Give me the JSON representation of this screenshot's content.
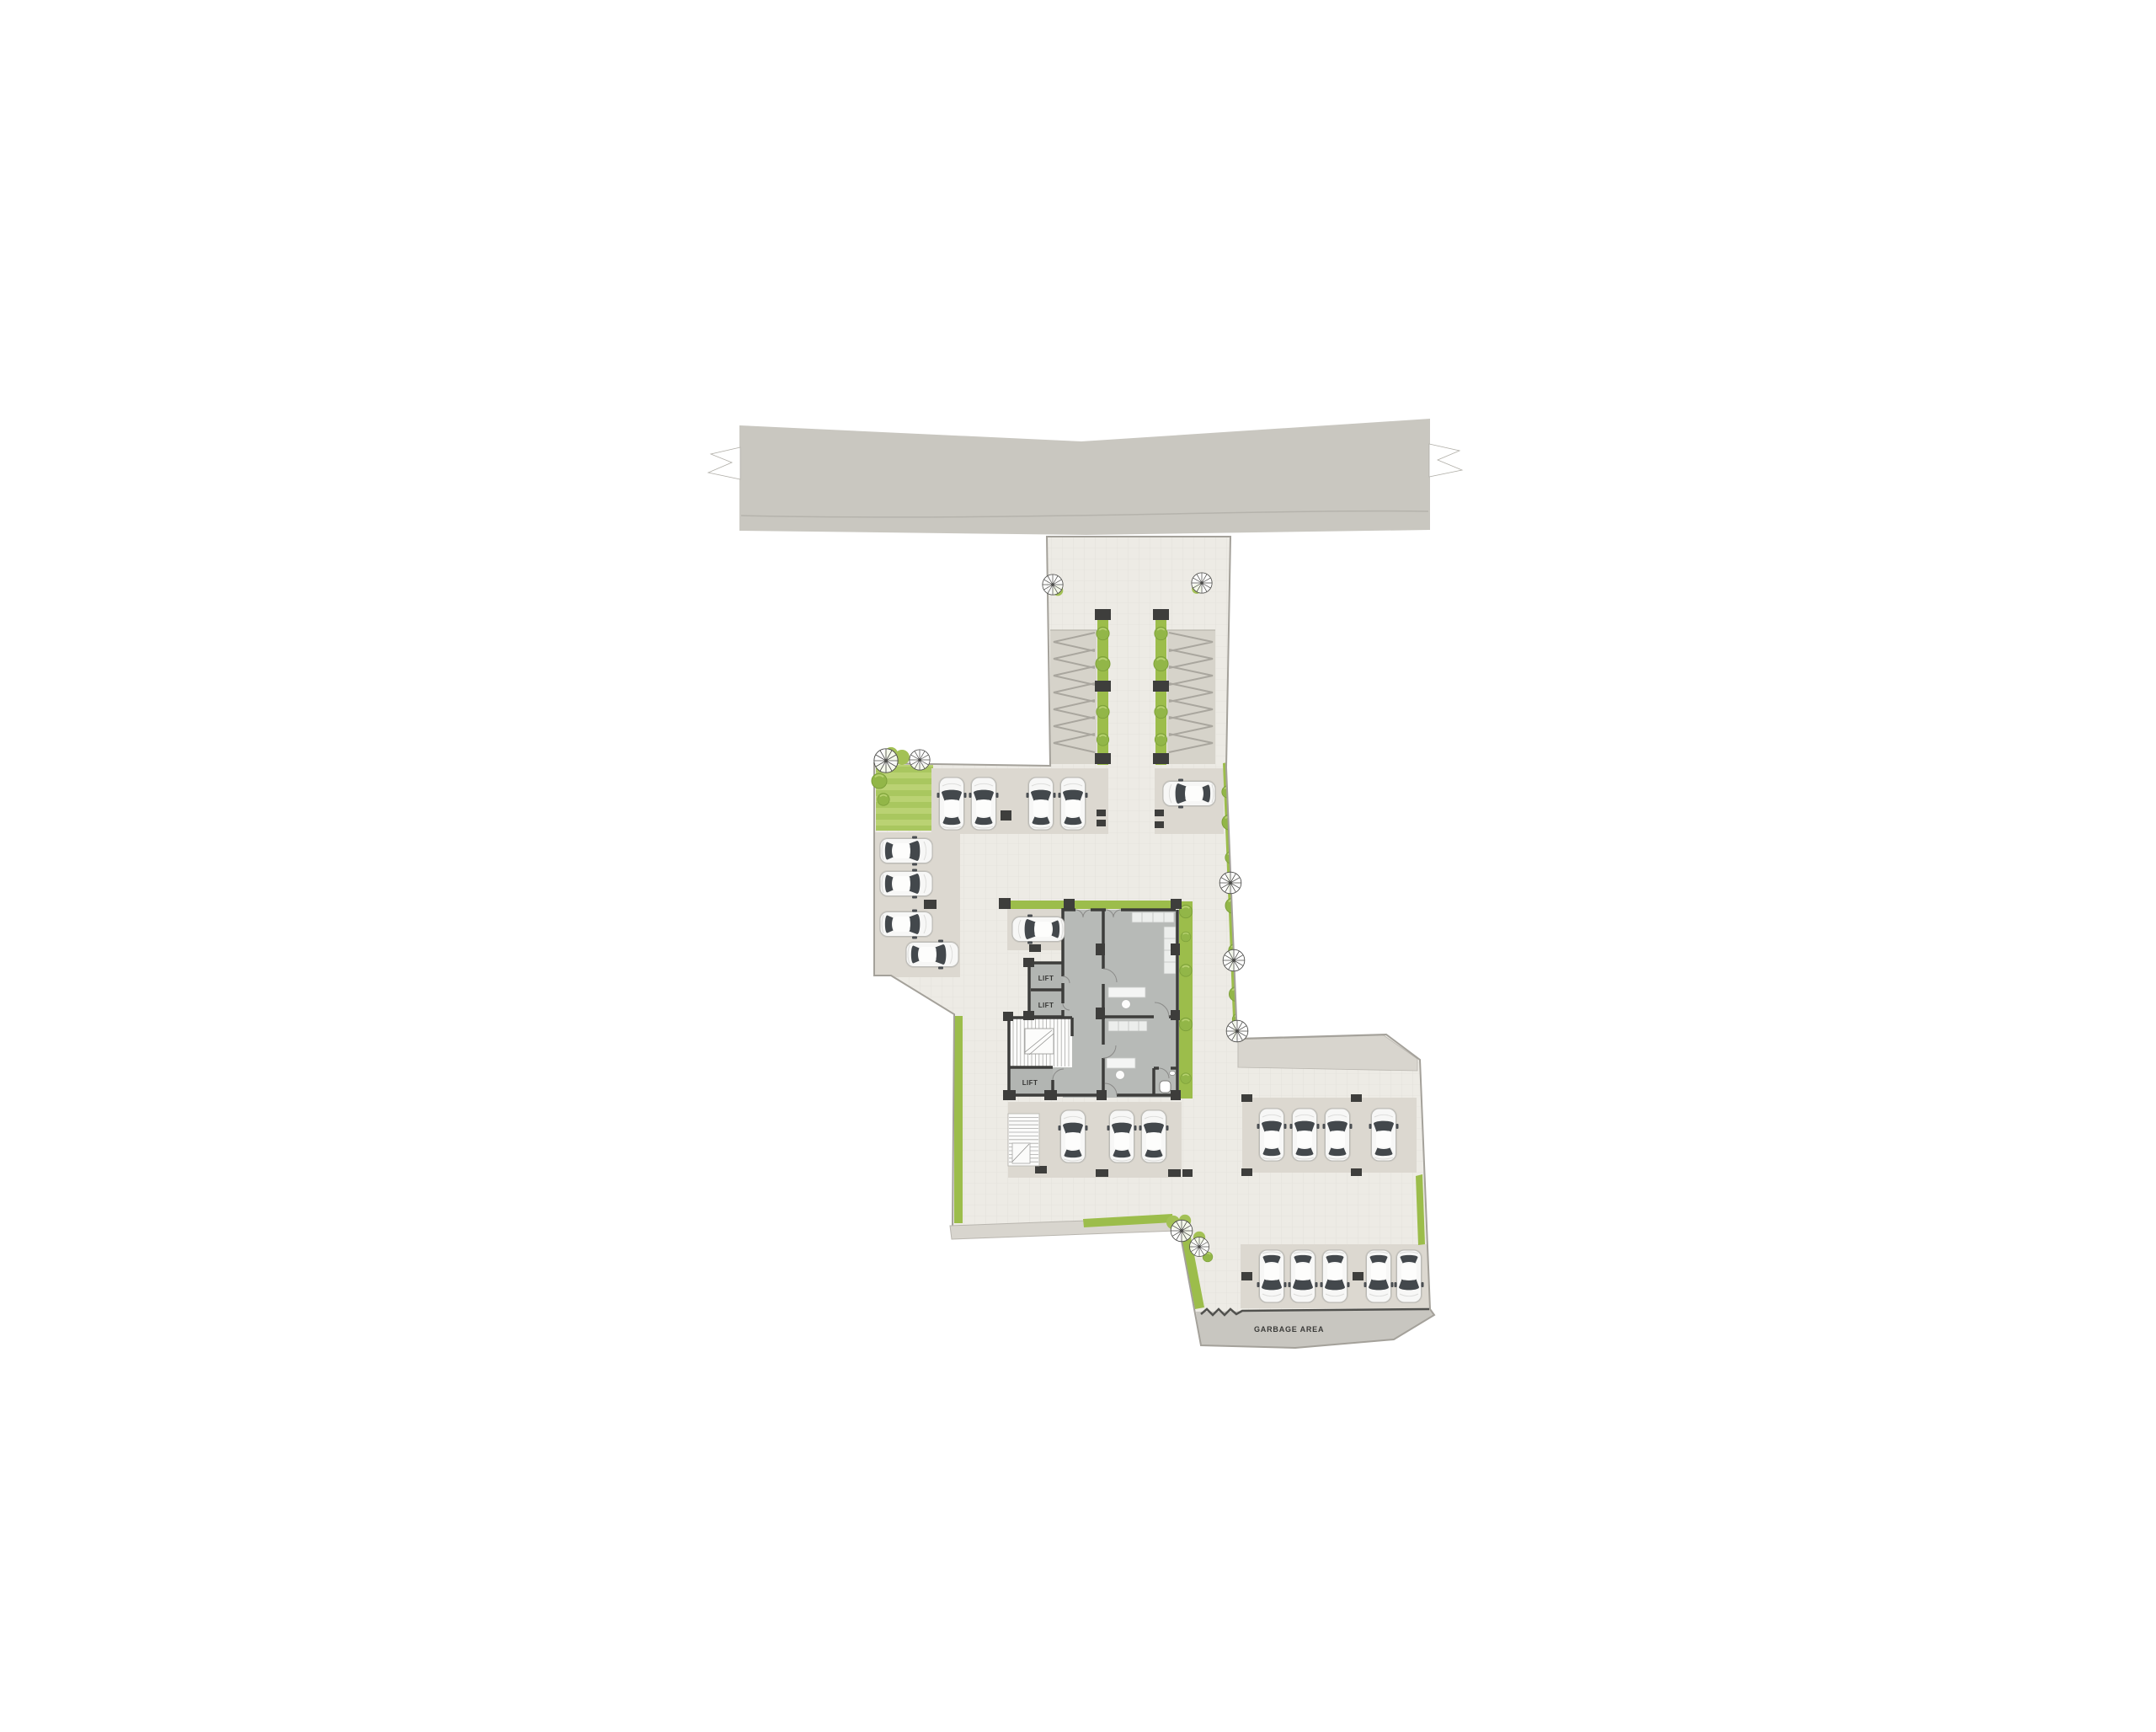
{
  "plan": {
    "labels": {
      "lift_1": "LIFT",
      "lift_2": "LIFT",
      "lift_3": "LIFT",
      "garbage_area": "GARBAGE AREA"
    },
    "colors": {
      "road": "#c9c7c0",
      "paving": "#edebe5",
      "stall_pad": "#dcd8d0",
      "sidewalk": "#d8d5ce",
      "building_floor": "#b7bab7",
      "wall": "#3d3d3b",
      "landscape_green": "#9cbd4b",
      "lawn_stripe_light": "#bad273",
      "lawn_stripe_dark": "#a9c75f",
      "car_body": "#f7f7f6",
      "car_glass": "#43484c",
      "marker": "#3e3e3c",
      "garbage_area_fill": "#c8c6c0"
    },
    "parking": {
      "total_cars": 22,
      "north_row_cars": 4,
      "north_single_car": 1,
      "west_column_cars": 4,
      "building_stall_cars": 1,
      "building_south_row_cars": 3,
      "east_row_cars": 4,
      "south_row_cars": 5
    },
    "building": {
      "lift_count": 3,
      "stair_count": 2
    }
  }
}
